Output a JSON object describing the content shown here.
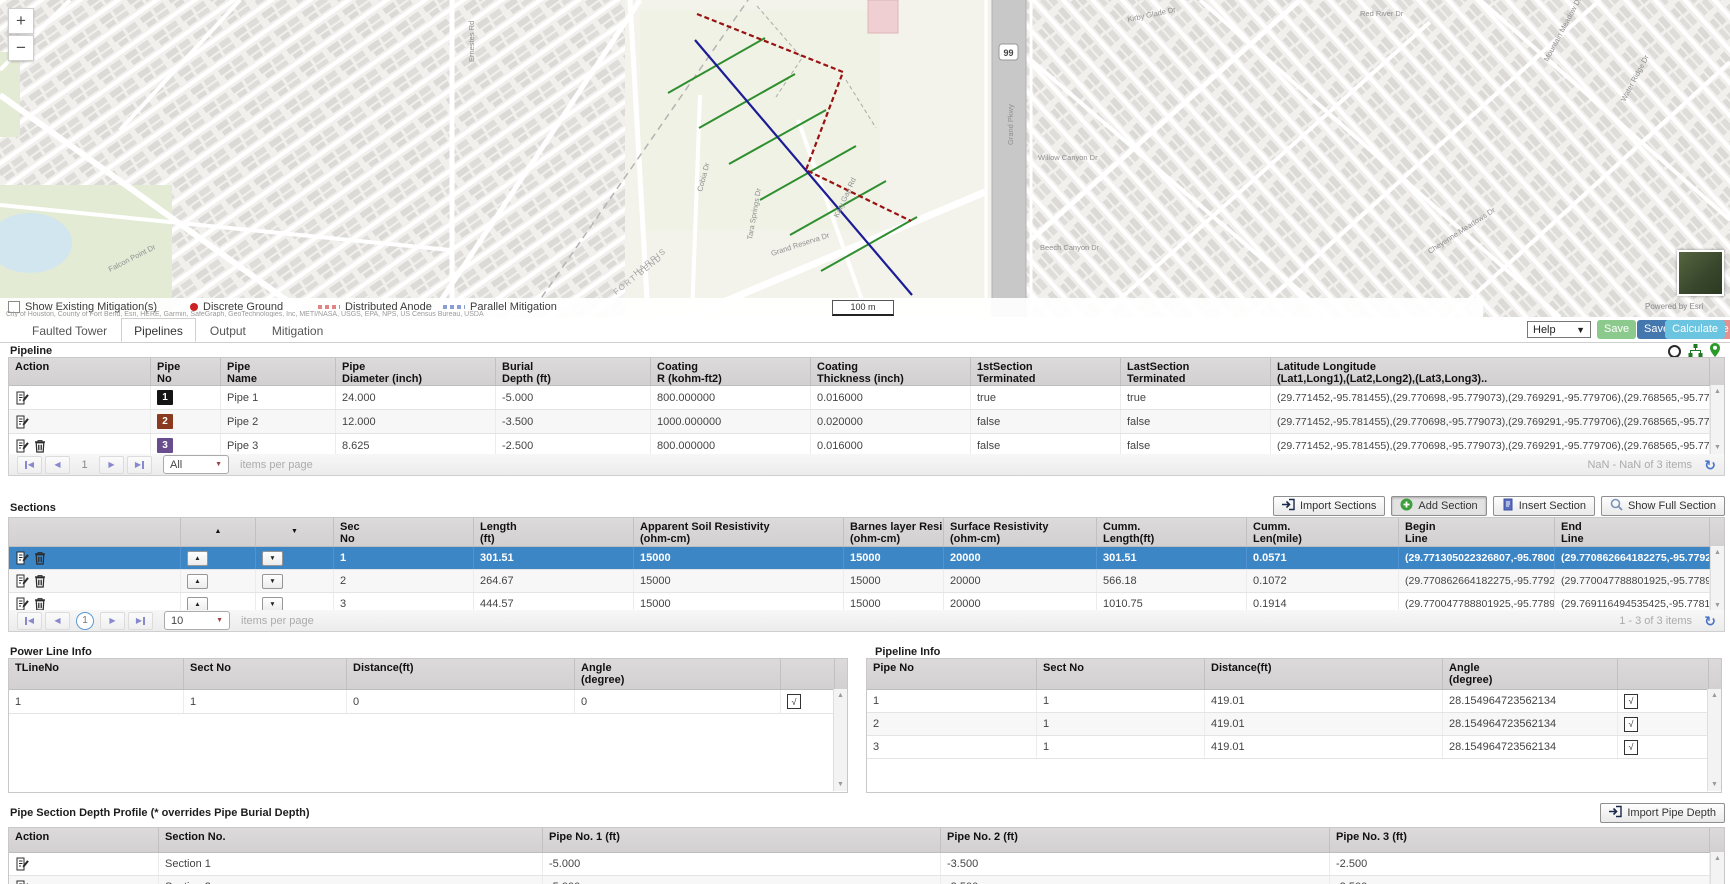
{
  "ui": {
    "sort_up": "▲",
    "sort_down": "▼",
    "check": "√",
    "refresh": "↻",
    "zoom_in": "+",
    "zoom_out": "−"
  },
  "map": {
    "legend": {
      "checkbox_label": "Show Existing Mitigation(s)",
      "items": [
        {
          "label": "Discrete Ground",
          "marker": "dot",
          "color": "#cc2222"
        },
        {
          "label": "Distributed Anode",
          "marker": "dashes",
          "color": "#e08585"
        },
        {
          "label": "Parallel Mitigation",
          "marker": "dashes",
          "color": "#8a9fd1"
        }
      ]
    },
    "scale_label": "100 m",
    "powered_by": "Powered by Esri",
    "attribution": "City of Houston, County of Fort Bend, Esri, HERE, Garmin, SafeGraph, GeoTechnologies, Inc, METI/NASA, USGS, EPA, NPS, US Census Bureau, USDA",
    "highway_shield": "99",
    "street_labels": [
      {
        "t": "Ernestes Rd",
        "x": 474,
        "y": 62,
        "r": -90
      },
      {
        "t": "Cobia Dr",
        "x": 702,
        "y": 192,
        "r": -75
      },
      {
        "t": "Katy Gap Rd",
        "x": 838,
        "y": 218,
        "r": -65
      },
      {
        "t": "Grand Pkwy",
        "x": 1013,
        "y": 145,
        "r": -90
      },
      {
        "t": "Grand Reserva Dr",
        "x": 772,
        "y": 256,
        "r": -18
      },
      {
        "t": "HARRIS",
        "x": 636,
        "y": 276,
        "r": -38,
        "cls": "county"
      },
      {
        "t": "FORT BEND",
        "x": 616,
        "y": 295,
        "r": -38,
        "cls": "county"
      },
      {
        "t": "Willow Canyon Dr",
        "x": 1038,
        "y": 160,
        "r": 0
      },
      {
        "t": "Beech Canyon Dr",
        "x": 1040,
        "y": 250,
        "r": 0
      },
      {
        "t": "Red River Dr",
        "x": 1360,
        "y": 16,
        "r": 0
      },
      {
        "t": "Mountain Meadow Dr",
        "x": 1548,
        "y": 62,
        "r": -62
      },
      {
        "t": "Water Ridge Dr",
        "x": 1625,
        "y": 102,
        "r": -62
      },
      {
        "t": "Cheyenne Meadows Dr",
        "x": 1430,
        "y": 254,
        "r": -33
      },
      {
        "t": "Falcon Point Dr",
        "x": 110,
        "y": 272,
        "r": -27
      },
      {
        "t": "Kirby Glade Dr",
        "x": 1128,
        "y": 22,
        "r": -12
      },
      {
        "t": "Tara Springs Dr",
        "x": 752,
        "y": 240,
        "r": -80
      }
    ]
  },
  "header": {
    "tabs": [
      {
        "label": "Faulted Tower",
        "active": false
      },
      {
        "label": "Pipelines",
        "active": true
      },
      {
        "label": "Output",
        "active": false
      },
      {
        "label": "Mitigation",
        "active": false
      }
    ],
    "toolbar": {
      "help": "Help",
      "save": "Save",
      "save_as": "Save As",
      "delete": "Delete",
      "calculate": "Calculate"
    }
  },
  "pipeline": {
    "title": "Pipeline",
    "columns": [
      [
        "Action"
      ],
      [
        "Pipe",
        "No"
      ],
      [
        "Pipe",
        "Name"
      ],
      [
        "Pipe",
        "Diameter (inch)"
      ],
      [
        "Burial",
        "Depth (ft)"
      ],
      [
        "Coating",
        "R (kohm-ft2)"
      ],
      [
        "Coating",
        "Thickness (inch)"
      ],
      [
        "1stSection",
        "Terminated"
      ],
      [
        "LastSection",
        "Terminated"
      ],
      [
        "Latitude Longitude",
        "(Lat1,Long1),(Lat2,Long2),(Lat3,Long3).."
      ]
    ],
    "rows": [
      {
        "actions": [
          "edit"
        ],
        "no": "1",
        "no_color": "#141414",
        "name": "Pipe 1",
        "diameter": "24.000",
        "burial": "-5.000",
        "coating_r": "800.000000",
        "coating_thickness": "0.016000",
        "first": "true",
        "last": "true",
        "latlong": "(29.771452,-95.781455),(29.770698,-95.779073),(29.769291,-95.779706),(29.768565,-95.777957)"
      },
      {
        "actions": [
          "edit"
        ],
        "no": "2",
        "no_color": "#8a3a1f",
        "name": "Pipe 2",
        "diameter": "12.000",
        "burial": "-3.500",
        "coating_r": "1000.000000",
        "coating_thickness": "0.020000",
        "first": "false",
        "last": "false",
        "latlong": "(29.771452,-95.781455),(29.770698,-95.779073),(29.769291,-95.779706),(29.768565,-95.777957)"
      },
      {
        "actions": [
          "edit",
          "delete"
        ],
        "no": "3",
        "no_color": "#6a4d8e",
        "name": "Pipe 3",
        "diameter": "8.625",
        "burial": "-2.500",
        "coating_r": "800.000000",
        "coating_thickness": "0.016000",
        "first": "false",
        "last": "false",
        "latlong": "(29.771452,-95.781455),(29.770698,-95.779073),(29.769291,-95.779706),(29.768565,-95.777957)"
      }
    ],
    "pager": {
      "page": "1",
      "per_page": "All",
      "items_label": "items per page",
      "info": "NaN - NaN of 3 items"
    }
  },
  "sections": {
    "title": "Sections",
    "buttons": [
      "Import Sections",
      "Add Section",
      "Insert Section",
      "Show Full Section"
    ],
    "columns": [
      [
        ""
      ],
      [
        "▲"
      ],
      [
        "▼"
      ],
      [
        "Sec",
        "No"
      ],
      [
        "Length",
        "(ft)"
      ],
      [
        "Apparent Soil Resistivity",
        "(ohm-cm)"
      ],
      [
        "Barnes layer Resistivity",
        "(ohm-cm)"
      ],
      [
        "Surface Resistivity",
        "(ohm-cm)"
      ],
      [
        "Cumm.",
        "Length(ft)"
      ],
      [
        "Cumm.",
        "Len(mile)"
      ],
      [
        "Begin",
        "Line"
      ],
      [
        "End",
        "Line"
      ]
    ],
    "rows": [
      {
        "selected": true,
        "actions": [
          "edit",
          "delete"
        ],
        "sec": "1",
        "length": "301.51",
        "asr": "15000",
        "barnes": "15000",
        "surface": "20000",
        "cumm_ft": "301.51",
        "cumm_mile": "0.0571",
        "begin": "(29.771305022326807,-95.78000087535352)",
        "end": "(29.770862664182275,-95.77927667891853)"
      },
      {
        "selected": false,
        "actions": [
          "edit",
          "delete"
        ],
        "sec": "2",
        "length": "264.67",
        "asr": "15000",
        "barnes": "15000",
        "surface": "20000",
        "cumm_ft": "566.18",
        "cumm_mile": "0.1072",
        "begin": "(29.770862664182275,-95.77927667891853)",
        "end": "(29.770047788801925,-95.77895481383229)"
      },
      {
        "selected": false,
        "actions": [
          "edit",
          "delete"
        ],
        "sec": "3",
        "length": "444.57",
        "asr": "15000",
        "barnes": "15000",
        "surface": "20000",
        "cumm_ft": "1010.75",
        "cumm_mile": "0.1914",
        "begin": "(29.770047788801925,-95.77895481383229)",
        "end": "(29.769116494535425,-95.77817697322413)"
      }
    ],
    "pager": {
      "page": "1",
      "per_page": "10",
      "items_label": "items per page",
      "info": "1 - 3 of 3 items"
    }
  },
  "power_line_info": {
    "title": "Power Line Info",
    "columns": [
      [
        "TLineNo"
      ],
      [
        "Sect No"
      ],
      [
        "Distance(ft)"
      ],
      [
        "Angle",
        "(degree)"
      ],
      [
        ""
      ]
    ],
    "rows": [
      {
        "tline": "1",
        "sect": "1",
        "distance": "0",
        "angle": "0"
      }
    ]
  },
  "pipeline_info": {
    "title": "Pipeline Info",
    "columns": [
      [
        "Pipe No"
      ],
      [
        "Sect No"
      ],
      [
        "Distance(ft)"
      ],
      [
        "Angle",
        "(degree)"
      ],
      [
        ""
      ]
    ],
    "rows": [
      {
        "pipe": "1",
        "sect": "1",
        "distance": "419.01",
        "angle": "28.154964723562134"
      },
      {
        "pipe": "2",
        "sect": "1",
        "distance": "419.01",
        "angle": "28.154964723562134"
      },
      {
        "pipe": "3",
        "sect": "1",
        "distance": "419.01",
        "angle": "28.154964723562134"
      }
    ]
  },
  "depth_profile": {
    "title": "Pipe Section Depth Profile (* overrides Pipe Burial Depth)",
    "import_button": "Import Pipe Depth",
    "columns": [
      [
        "Action"
      ],
      [
        "Section No."
      ],
      [
        "Pipe No. 1 (ft)"
      ],
      [
        "Pipe No. 2 (ft)"
      ],
      [
        "Pipe No. 3 (ft)"
      ]
    ],
    "rows": [
      {
        "actions": [
          "edit"
        ],
        "section": "Section 1",
        "p1": "-5.000",
        "p2": "-3.500",
        "p3": "-2.500"
      },
      {
        "actions": [
          "edit"
        ],
        "section": "Section 2",
        "p1": "-5.000",
        "p2": "-3.500",
        "p3": "-2.500"
      }
    ]
  }
}
